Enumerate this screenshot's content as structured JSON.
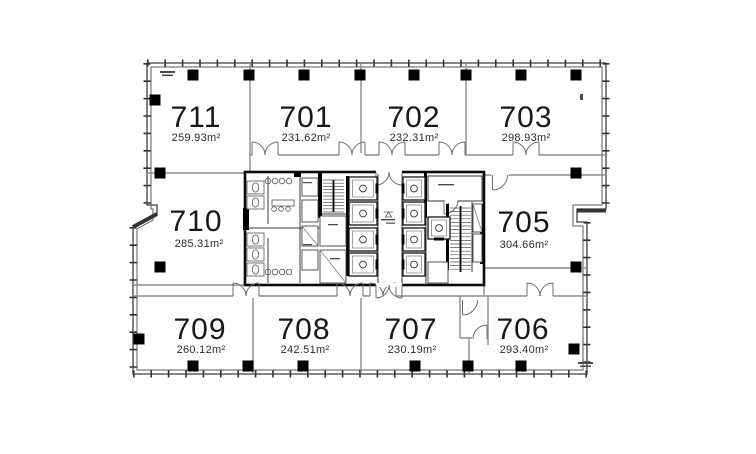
{
  "plan": {
    "type": "office-floor-plan",
    "area_unit": "m²",
    "rooms": {
      "r711": {
        "number": "711",
        "area": "259.93m²"
      },
      "r701": {
        "number": "701",
        "area": "231.62m²"
      },
      "r702": {
        "number": "702",
        "area": "232.31m²"
      },
      "r703": {
        "number": "703",
        "area": "298.93m²"
      },
      "r710": {
        "number": "710",
        "area": "285.31m²"
      },
      "r705": {
        "number": "705",
        "area": "304.66m²"
      },
      "r709": {
        "number": "709",
        "area": "260.12m²"
      },
      "r708": {
        "number": "708",
        "area": "242.51m²"
      },
      "r707": {
        "number": "707",
        "area": "230.19m²"
      },
      "r706": {
        "number": "706",
        "area": "293.40m²"
      }
    }
  }
}
